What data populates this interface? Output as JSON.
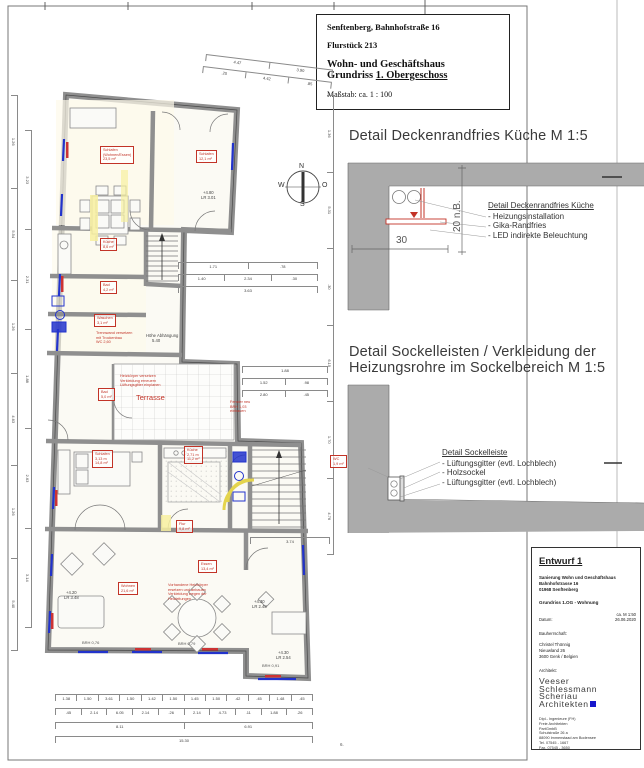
{
  "title_block": {
    "line1": "Senftenberg, Bahnhofstraße 16",
    "line2": "Flurstück 213",
    "line3": "Wohn- und Geschäftshaus",
    "line4_prefix": "Grundriss ",
    "line4_underlined": "1. Obergeschoss",
    "scale": "Maßstab: ca. 1 : 100"
  },
  "detail1": {
    "heading": "Detail Deckenrandfries Küche M 1:5",
    "label_title": "Detail Deckenrandfries Küche",
    "items": [
      "- Heizungsinstallation",
      "- Gika-Randfries",
      "- LED indirekte Beleuchtung"
    ],
    "dim_h": "30",
    "dim_v": "20 n.B."
  },
  "detail2": {
    "heading_line1": "Detail Sockelleisten / Verkleidung der",
    "heading_line2": "Heizungsrohre im Sockelbereich M 1:5",
    "label_title": "Detail Sockelleiste",
    "items": [
      "- Lüftungsgitter (evtl. Lochblech)",
      "- Holzsockel",
      "- Lüftungsgitter (evtl. Lochblech)"
    ]
  },
  "architect_block": {
    "title": "Entwurf 1",
    "project_lines": [
      "Sanierung Wohn und Geschäftshaus",
      "Bahnhofstrasse 16",
      "01968 Senftenberg"
    ],
    "drawing": "Grundriss 1.OG - Wohnung",
    "scale": "ca. M 1:50",
    "date_label": "Datum:",
    "date": "26.06.2020",
    "client_label": "Bauherrschaft:",
    "client_lines": [
      "Christel Thönnig",
      "Nieuwland 26",
      "3600 Genk / Belgien"
    ],
    "architect_label": "Architekt:",
    "logo_lines": [
      "Veeser",
      "Schlessmann",
      "Scheriau"
    ],
    "logo_last": "Architekten",
    "office_lines": [
      "Dipl.- Ingenieure (FH)",
      "Freie Architekten",
      "PartGmbB",
      "Schulstraße 26 a",
      "88090 Immenstaad am Bodensee",
      "Tel.   07545 - 1667",
      "Fax.   07545 - 3650"
    ]
  },
  "plan": {
    "room_labels": [
      {
        "x": 100,
        "y": 146,
        "lines": [
          "Schlafen",
          "(Wohnen/Essen)",
          "23,5 m²"
        ]
      },
      {
        "x": 196,
        "y": 150,
        "lines": [
          "Schlafen",
          "12,1 m²"
        ]
      },
      {
        "x": 100,
        "y": 238,
        "lines": [
          "Küche",
          "8,6 m²"
        ]
      },
      {
        "x": 100,
        "y": 281,
        "lines": [
          "Bad",
          "4,2 m²"
        ]
      },
      {
        "x": 94,
        "y": 314,
        "lines": [
          "Waschen",
          "3,1 m²"
        ]
      },
      {
        "x": 98,
        "y": 388,
        "lines": [
          "Bad",
          "5,0 m²"
        ]
      },
      {
        "x": 92,
        "y": 450,
        "lines": [
          "Schlafen",
          "3,13 m",
          "14,8 m²"
        ]
      },
      {
        "x": 184,
        "y": 446,
        "lines": [
          "Küche",
          "2,71 m",
          "11,2 m²"
        ]
      },
      {
        "x": 176,
        "y": 520,
        "lines": [
          "Flur",
          "9,8 m²"
        ]
      },
      {
        "x": 198,
        "y": 560,
        "lines": [
          "Essen",
          "13,4 m²"
        ]
      },
      {
        "x": 118,
        "y": 582,
        "lines": [
          "Wohnen",
          "21,6 m²"
        ]
      },
      {
        "x": 330,
        "y": 455,
        "lines": [
          "WC",
          "1,9 m²"
        ]
      }
    ],
    "red_notes": [
      {
        "x": 96,
        "y": 331,
        "lines": [
          "Trennwand versetzen",
          "mit Trockenbau",
          "WC 2,60"
        ]
      },
      {
        "x": 120,
        "y": 374,
        "lines": [
          "Heizkörper versetzen",
          "Verkleidung erneuern",
          "Lüftungsgitter einplanen"
        ]
      },
      {
        "x": 230,
        "y": 400,
        "lines": [
          "Fenster neu",
          "BRH 1,03",
          "einbauen"
        ]
      },
      {
        "x": 168,
        "y": 583,
        "lines": [
          "Vorhandene Heizkörper",
          "ersetzen und anbauen",
          "Verkleidung wegen der",
          "Heizleitungen"
        ]
      }
    ],
    "free_texts": [
      {
        "x": 299,
        "y": 163,
        "t": "N",
        "s": 7,
        "c": "#333"
      },
      {
        "x": 278,
        "y": 182,
        "t": "W",
        "s": 7,
        "c": "#333"
      },
      {
        "x": 300,
        "y": 201,
        "t": "S",
        "s": 7,
        "c": "#333"
      },
      {
        "x": 322,
        "y": 182,
        "t": "O",
        "s": 7,
        "c": "#333"
      },
      {
        "x": 136,
        "y": 393,
        "t": "Terrasse",
        "s": 7.5,
        "c": "#c23327"
      },
      {
        "x": 146,
        "y": 333,
        "t": "Höhe Abhängung",
        "s": 4.2,
        "c": "#444"
      },
      {
        "x": 152,
        "y": 338,
        "t": "5.40",
        "s": 4.2,
        "c": "#444"
      },
      {
        "x": 203,
        "y": 190,
        "t": "+4.80",
        "s": 4.2,
        "c": "#444"
      },
      {
        "x": 201,
        "y": 195,
        "t": "LR 3.01",
        "s": 4.2,
        "c": "#444"
      },
      {
        "x": 66,
        "y": 590,
        "t": "+4.20",
        "s": 4.2,
        "c": "#444"
      },
      {
        "x": 64,
        "y": 595,
        "t": "LR 3.48",
        "s": 4.2,
        "c": "#444"
      },
      {
        "x": 254,
        "y": 599,
        "t": "+4.30",
        "s": 4.2,
        "c": "#444"
      },
      {
        "x": 252,
        "y": 604,
        "t": "LR 2.48",
        "s": 4.2,
        "c": "#444"
      },
      {
        "x": 278,
        "y": 650,
        "t": "+4.30",
        "s": 4.2,
        "c": "#444"
      },
      {
        "x": 276,
        "y": 655,
        "t": "LR 2.54",
        "s": 4.2,
        "c": "#444"
      },
      {
        "x": 82,
        "y": 640,
        "t": "BRH 0,76",
        "s": 4,
        "c": "#555"
      },
      {
        "x": 178,
        "y": 641,
        "t": "BRH 0,79",
        "s": 4,
        "c": "#555"
      },
      {
        "x": 262,
        "y": 663,
        "t": "BRH 0,91",
        "s": 4,
        "c": "#555"
      },
      {
        "x": 340,
        "y": 742,
        "t": "6.",
        "s": 4.5,
        "c": "#555"
      }
    ],
    "dim_chains": [
      {
        "x": 206,
        "y": 54,
        "len": 128,
        "rot": 7,
        "values": [
          "4.47",
          "3.90"
        ]
      },
      {
        "x": 203,
        "y": 66,
        "len": 130,
        "rot": 7,
        "values": [
          ".20",
          "4.42",
          ".85"
        ]
      },
      {
        "x": 18,
        "y": 95,
        "len": 556,
        "dir": "v",
        "values": [
          "1.26",
          "5.54",
          "1.26",
          "4.63",
          "1.26",
          "5.40"
        ]
      },
      {
        "x": 32,
        "y": 130,
        "len": 498,
        "dir": "v",
        "values": [
          "3.23",
          "2.31",
          "1.88",
          "2.63",
          "3.14"
        ]
      },
      {
        "x": 334,
        "y": 95,
        "len": 460,
        "dir": "v",
        "values": [
          "1.36",
          "5.31",
          ".30",
          "6.15",
          "1.70",
          "4.76"
        ]
      },
      {
        "x": 178,
        "y": 262,
        "len": 140,
        "values": [
          "1.71",
          ".78"
        ]
      },
      {
        "x": 178,
        "y": 274,
        "len": 140,
        "values": [
          "1.40",
          "2.34",
          ".30"
        ]
      },
      {
        "x": 178,
        "y": 286,
        "len": 140,
        "values": [
          "3.63"
        ]
      },
      {
        "x": 242,
        "y": 366,
        "len": 86,
        "values": [
          "1.88"
        ]
      },
      {
        "x": 242,
        "y": 378,
        "len": 86,
        "values": [
          "1.52",
          ".98"
        ]
      },
      {
        "x": 242,
        "y": 390,
        "len": 86,
        "values": [
          "2.80",
          ".45"
        ]
      },
      {
        "x": 250,
        "y": 537,
        "len": 80,
        "values": [
          "3.74"
        ]
      },
      {
        "x": 55,
        "y": 694,
        "len": 258,
        "values": [
          "1.38",
          "1.50",
          "3.61",
          "1.50",
          "1.42",
          "1.50",
          "1.45",
          "1.50",
          ".42",
          ".45",
          "1.48",
          ".45"
        ]
      },
      {
        "x": 55,
        "y": 708,
        "len": 258,
        "values": [
          ".45",
          "2.14",
          "6.05",
          "2.14",
          ".26",
          "2.14",
          "4.73",
          ".11",
          "1.88",
          ".26"
        ]
      },
      {
        "x": 55,
        "y": 722,
        "len": 258,
        "values": [
          "8.11",
          "6.91"
        ]
      },
      {
        "x": 55,
        "y": 736,
        "len": 258,
        "values": [
          "15.30"
        ]
      }
    ]
  }
}
